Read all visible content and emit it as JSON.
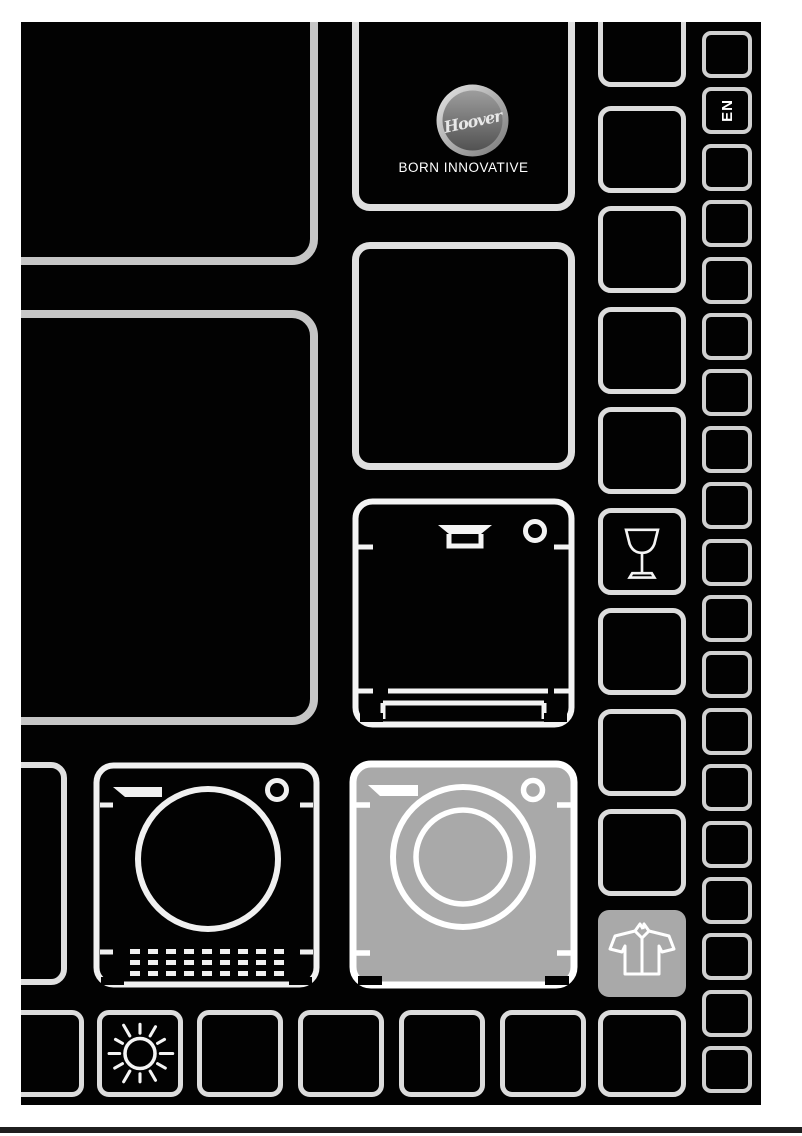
{
  "brand": {
    "logo_text": "Hoover",
    "tagline": "BORN INNOVATIVE"
  },
  "language_badge": {
    "label": "EN"
  },
  "icons": {
    "logo": "hoover-logo",
    "dishwasher": "dishwasher",
    "washing_machine": "washing-machine",
    "tumble_dryer": "tumble-dryer",
    "wine_glass": "wine-glass",
    "shirt": "shirt",
    "sun": "sun"
  },
  "colors": {
    "page_bg": "#ffffff",
    "canvas": "#020202",
    "outline_gray": "#c6c6c6",
    "cell_outline": "#dcdcdc",
    "icon_stroke": "#f4f4f4",
    "highlight_fill": "#a9a9a9",
    "footer_rule": "#1f1f1f"
  }
}
